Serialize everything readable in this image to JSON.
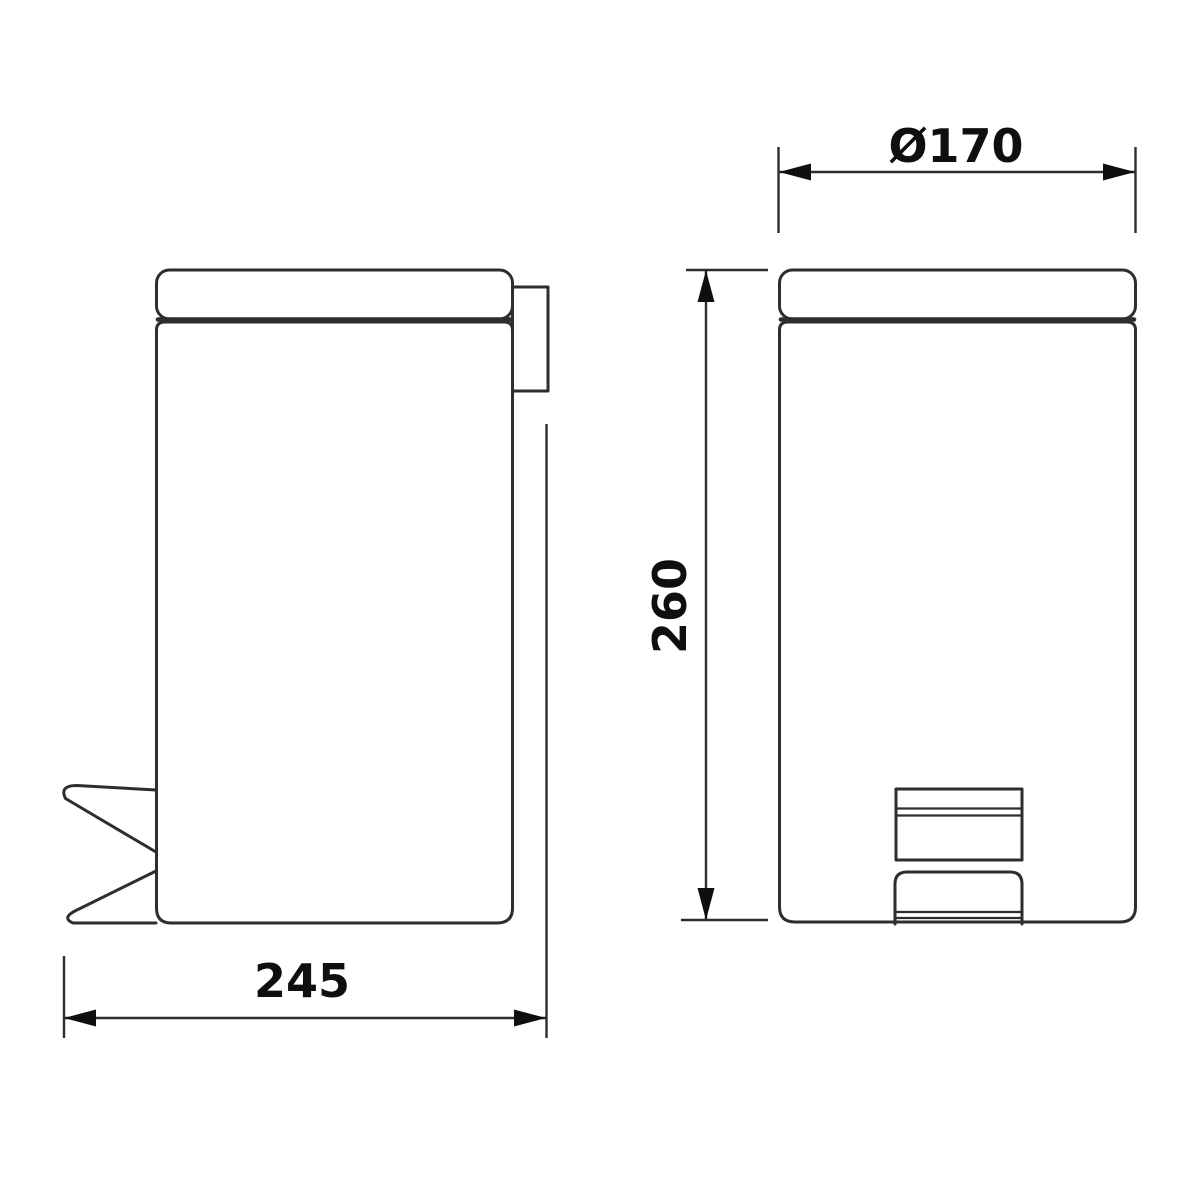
{
  "drawing": {
    "kind": "technical dimension drawing",
    "subject": "pedal waste bin, side view and front view"
  },
  "dimensions": {
    "diameter_label": "Ø170",
    "height_label": "260",
    "depth_label": "245"
  },
  "colors": {
    "line": "#2e2e2e",
    "text": "#0f0f0f",
    "background": "#ffffff"
  }
}
